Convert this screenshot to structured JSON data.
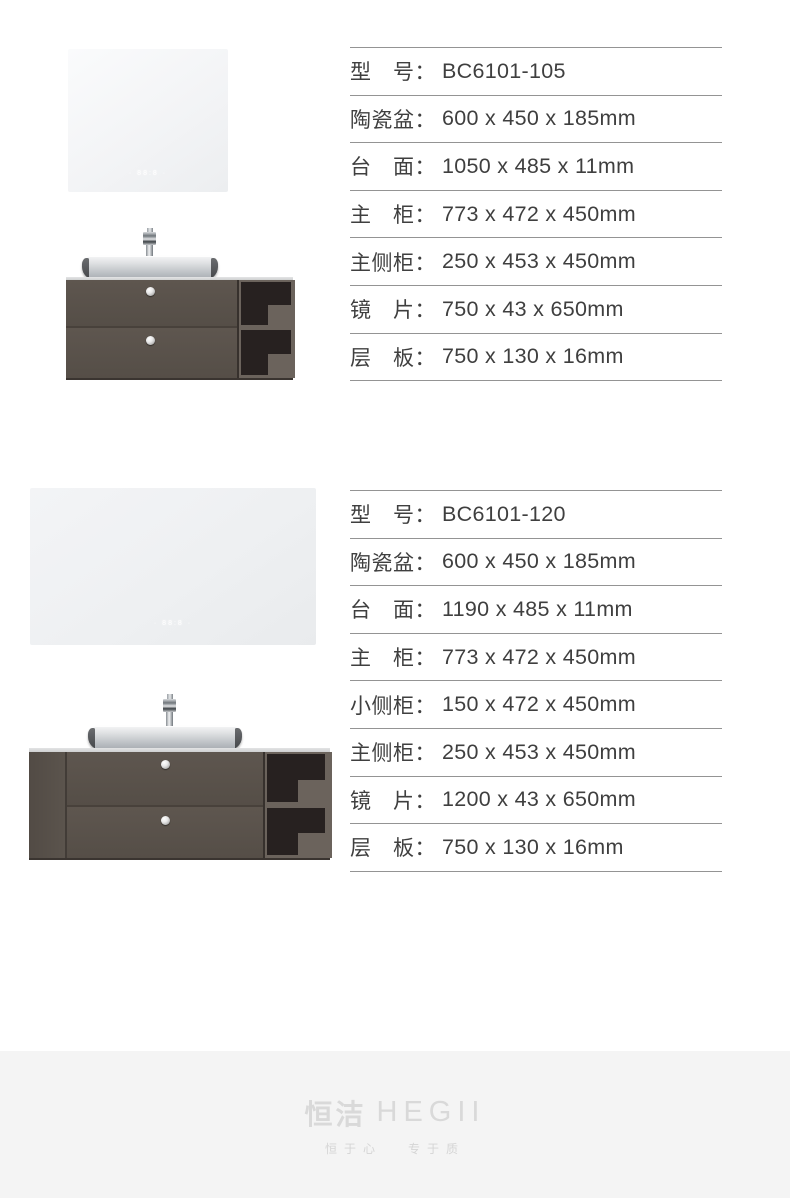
{
  "products": [
    {
      "model": "BC6101-105",
      "mirror_display": "· 88:8 ·",
      "specs": [
        {
          "label": "型　号：",
          "value": "BC6101-105"
        },
        {
          "label": "陶瓷盆：",
          "value": "600 x 450 x 185mm"
        },
        {
          "label": "台　面：",
          "value": "1050 x 485 x 11mm"
        },
        {
          "label": "主　柜：",
          "value": "773 x 472 x 450mm"
        },
        {
          "label": "主侧柜：",
          "value": "250 x 453 x 450mm"
        },
        {
          "label": "镜　片：",
          "value": "750 x 43 x 650mm"
        },
        {
          "label": "层　板：",
          "value": "750 x 130 x 16mm"
        }
      ]
    },
    {
      "model": "BC6101-120",
      "mirror_display": "· 88:8 ·",
      "specs": [
        {
          "label": "型　号：",
          "value": "BC6101-120"
        },
        {
          "label": "陶瓷盆：",
          "value": "600 x 450 x 185mm"
        },
        {
          "label": "台　面：",
          "value": "1190 x 485 x 11mm"
        },
        {
          "label": "主　柜：",
          "value": "773 x 472 x 450mm"
        },
        {
          "label": "小侧柜：",
          "value": "150 x 472 x 450mm"
        },
        {
          "label": "主侧柜：",
          "value": "250 x 453 x 450mm"
        },
        {
          "label": "镜　片：",
          "value": "1200 x 43 x 650mm"
        },
        {
          "label": "层　板：",
          "value": "750 x 130 x 16mm"
        }
      ]
    }
  ],
  "footer": {
    "logo_cn": "恒洁",
    "logo_en": "HEGII",
    "tagline_left": "恒于心",
    "tagline_right": "专于质"
  },
  "colors": {
    "table_rule": "#949494",
    "spec_text": "#3f3f3f",
    "cabinet_body": "#57504a",
    "shelf_dark": "#272120",
    "shelf_frame": "#6b635c",
    "footer_bg": "#f4f4f4",
    "footer_logo": "#d9d9d9"
  }
}
